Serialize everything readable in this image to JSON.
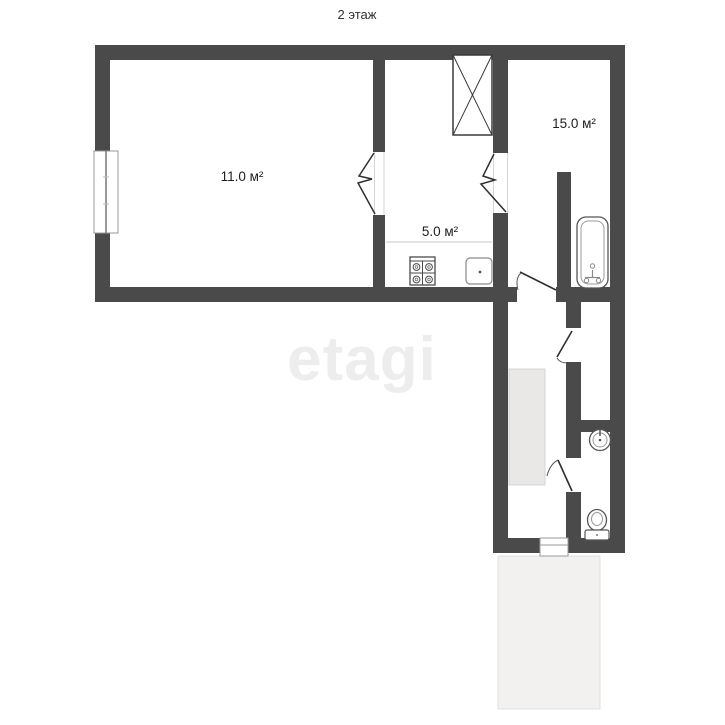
{
  "floorplan": {
    "title": "2 этаж",
    "watermark": "etagi",
    "rooms": [
      {
        "id": "room-left",
        "area_label": "11.0 м²"
      },
      {
        "id": "kitchen",
        "area_label": "5.0 м²"
      },
      {
        "id": "room-right",
        "area_label": "15.0 м²"
      }
    ],
    "fixtures": [
      "window",
      "ventilation-shaft",
      "stove",
      "kitchen-sink",
      "bathtub",
      "washbasin",
      "toilet",
      "door-swing",
      "opening-break",
      "built-in-closet",
      "balcony",
      "threshold"
    ],
    "colors": {
      "wall": "#4a4a4a",
      "label_text": "#1e1e1e",
      "watermark": "#ededed",
      "balcony_fill": "#f2f1ef",
      "closet_fill": "#e9e8e6"
    }
  }
}
